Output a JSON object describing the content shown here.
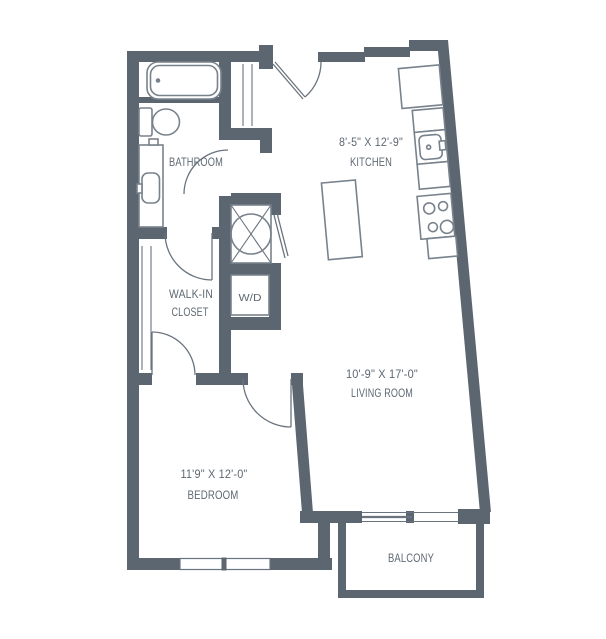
{
  "title": "Apartment Floor Plan",
  "colors": {
    "wall": "#5b6670",
    "fixture_outline": "#78828c",
    "door_line": "#6a747e",
    "text": "#5d6872",
    "background": "#ffffff"
  },
  "rooms": {
    "bathroom": {
      "label": "BATHROOM"
    },
    "kitchen": {
      "dims": "8'-5\" X 12'-9\"",
      "label": "KITCHEN"
    },
    "walk_in_closet": {
      "line1": "WALK-IN",
      "line2": "CLOSET"
    },
    "laundry": {
      "label": "W/D"
    },
    "living_room": {
      "dims": "10'-9\" X 17'-0\"",
      "label": "LIVING ROOM"
    },
    "bedroom": {
      "dims": "11'9\" X 12'-0\"",
      "label": "BEDROOM"
    },
    "balcony": {
      "label": "BALCONY"
    }
  },
  "fixture_icons": [
    "bathtub-icon",
    "toilet-icon",
    "vanity-sink-icon",
    "shower-icon",
    "washer-dryer-icon",
    "refrigerator-icon",
    "kitchen-sink-icon",
    "stove-icon",
    "kitchen-island-icon",
    "entry-closet-icon",
    "closet-shelves-icon",
    "bedroom-window-icon",
    "balcony-sliding-door-icon"
  ]
}
